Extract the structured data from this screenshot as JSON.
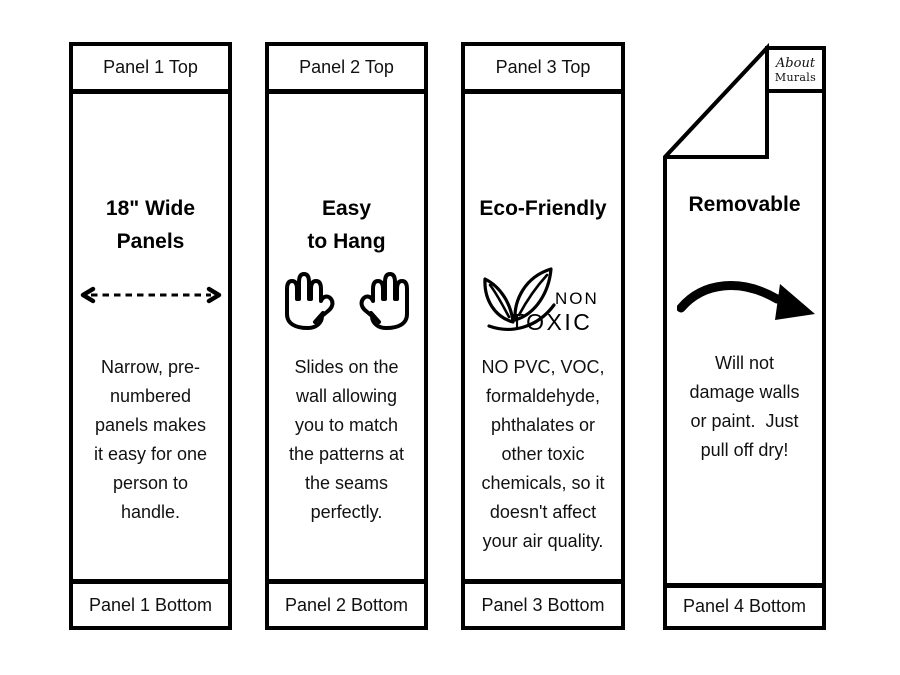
{
  "colors": {
    "background": "#ffffff",
    "ink": "#000000"
  },
  "panels": [
    {
      "top_label": "Panel 1 Top",
      "title_lines": [
        "18\" Wide",
        "Panels"
      ],
      "icon": "dashed-width-arrow",
      "body_lines": [
        "Narrow, pre-",
        "numbered",
        "panels makes",
        "it easy for one",
        "person to",
        "handle."
      ],
      "bottom_label": "Panel 1 Bottom"
    },
    {
      "top_label": "Panel 2 Top",
      "title_lines": [
        "Easy",
        "to Hang"
      ],
      "icon": "raised-hands",
      "body_lines": [
        "Slides on the",
        "wall allowing",
        "you to match",
        "the patterns at",
        "the seams",
        "perfectly."
      ],
      "bottom_label": "Panel 2 Bottom"
    },
    {
      "top_label": "Panel 3 Top",
      "title_lines": [
        "Eco-Friendly"
      ],
      "icon": "non-toxic-leaves",
      "icon_labels": {
        "non": "NON",
        "toxic": "TOXIC"
      },
      "body_lines": [
        "NO PVC, VOC,",
        "formaldehyde,",
        "phthalates or",
        "other toxic",
        "chemicals, so it",
        "doesn't affect",
        "your air quality."
      ],
      "bottom_label": "Panel 3 Bottom"
    },
    {
      "logo": {
        "line1": "About",
        "line2": "Murals"
      },
      "title_lines": [
        "Removable"
      ],
      "icon": "peel-off-arrow",
      "body_lines": [
        "Will not",
        "damage walls",
        "or paint.  Just",
        "pull off dry!"
      ],
      "bottom_label": "Panel 4 Bottom"
    }
  ]
}
